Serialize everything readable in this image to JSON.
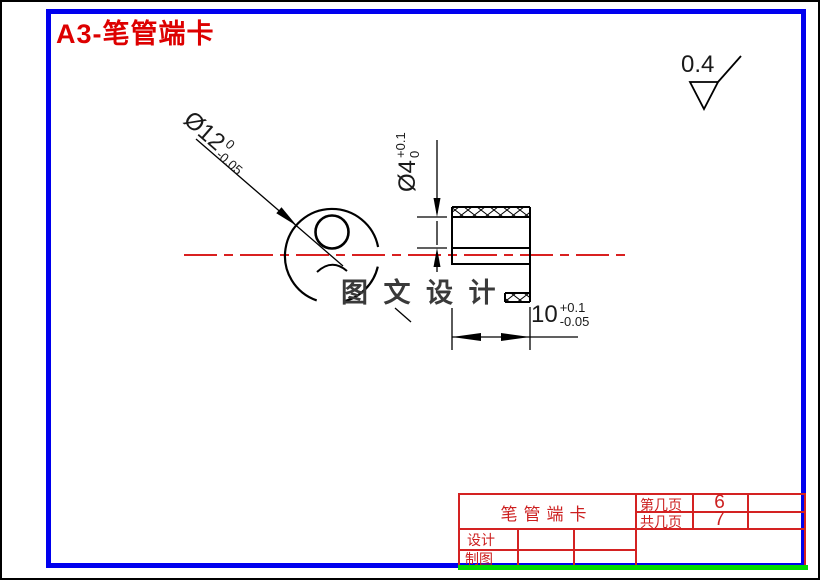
{
  "title": "A3-笔管端卡",
  "surface_finish": {
    "value": "0.4"
  },
  "dimensions": {
    "dia12": {
      "main": "Ø12",
      "upper": "0",
      "lower": "-0.05"
    },
    "dia4": {
      "main": "Ø4",
      "upper": "+0.1",
      "lower": "0"
    },
    "len10": {
      "main": "10",
      "upper": "+0.1",
      "lower": "-0.05"
    }
  },
  "watermark": "图 文 设 计",
  "title_block": {
    "part_name": "笔管端卡",
    "page_label": "第几页",
    "page_value": "6",
    "total_label": "共几页",
    "total_value": "7",
    "design_label": "设计",
    "draft_label": "制图"
  },
  "colors": {
    "frame_blue": "#0000ee",
    "table_red": "#d42222",
    "title_red": "#dd0000",
    "centerline_red": "#d40000",
    "strip_green": "#00dc00"
  }
}
